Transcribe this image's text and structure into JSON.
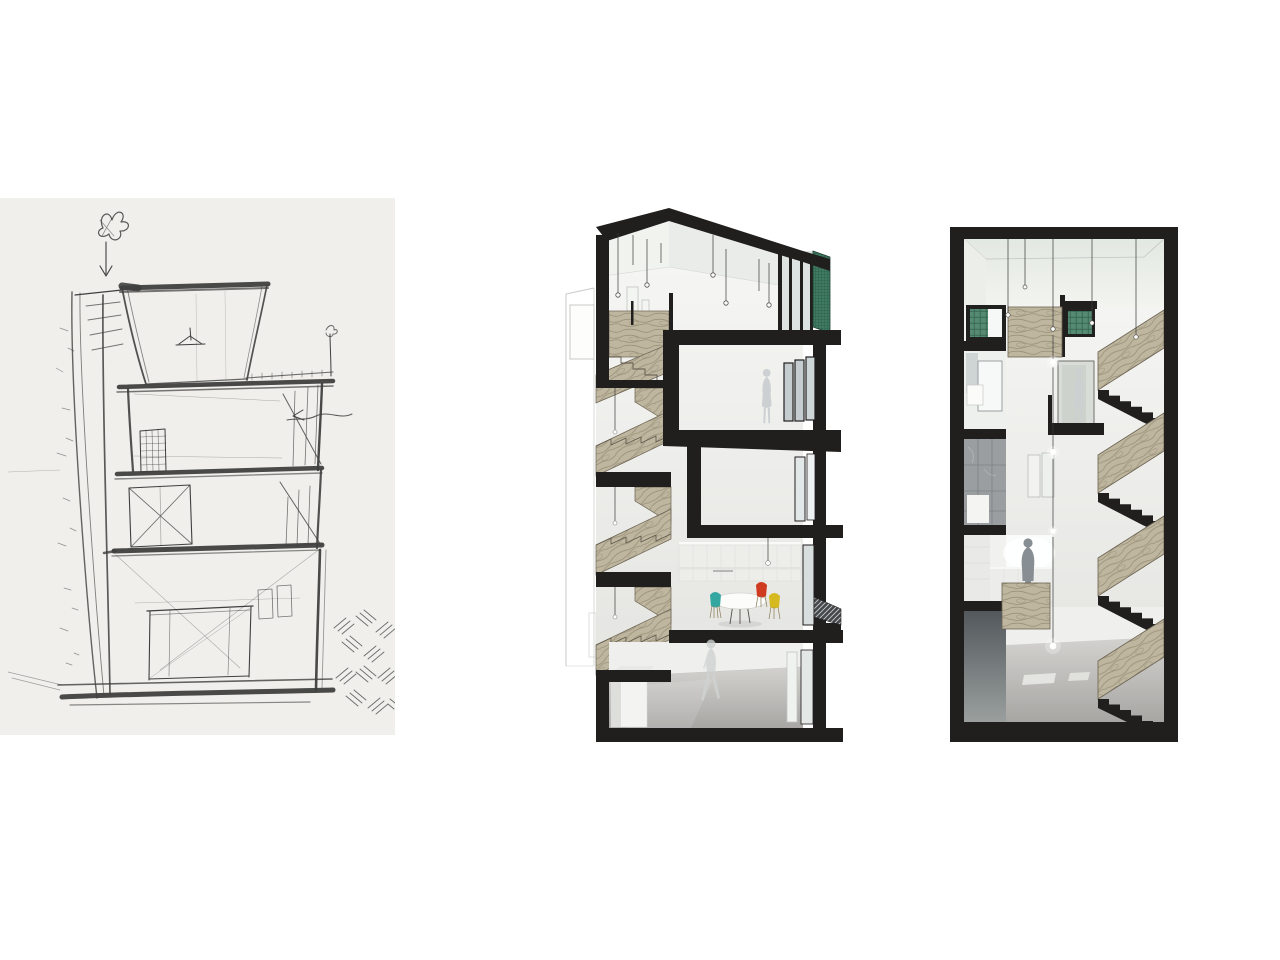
{
  "board": {
    "title": "architectural presentation board",
    "description": "Three-panel architectural study of a narrow multi-storey townhouse: concept sketch, sectional cutaway render, stair-core section render"
  },
  "panels": {
    "sketch": {
      "label": "concept-sketch",
      "medium": "pencil on paper",
      "description": "Hand-drawn pencil section sketch of a four-storey house with planting symbol and down arrow at top, sloped party wall with moss ticks at left, stair diagonals at right, double-height ground room with table, and basket-weave ground hatching at bottom right",
      "floors_visible": 4
    },
    "cutaway": {
      "label": "sectional-cutaway-render",
      "description": "Rendered sectional perspective: top-lit attic with pendant bulbs and timber switchback stair, bedroom with standing woman, white study room, kitchen-dining room with round white table and teal, red and yellow chairs, double-height ground hall with walking man, green perforated mesh screen at top right, concrete floors, black cut poche",
      "floors_visible": 5,
      "figures": [
        "standing woman",
        "walking man"
      ],
      "furniture": [
        "round dining table",
        "teal chair",
        "red chair",
        "yellow chair"
      ]
    },
    "stairwell": {
      "label": "stair-core-section-render",
      "description": "Rendered section through the stair core framed in black poche: timber scissor stair flights with black stepped soffits, green glass-block windows, bathroom, marble shower room, kitchen with backlit standing man, woman by a door, glowing pendant bulbs dropping through the void, concrete ground slab",
      "floors_visible": 5,
      "stair_flights_visible": 4,
      "figures": [
        "standing woman",
        "standing man"
      ]
    }
  },
  "palette": {
    "page_bg": "#ffffff",
    "sketch_paper": "#f0efec",
    "pencil": "#3f3f3f",
    "poche": "#211f1e",
    "wall_light": "#f6f6f4",
    "wall_shade": "#e3e3e0",
    "ceiling_green": "#e4eae2",
    "wood_base": "#bfb6a0",
    "wood_grain": "#857c63",
    "glass_block_green": "#4c7e67",
    "mesh_green": "#3f7a62",
    "concrete_light": "#d2d1ce",
    "concrete_dark": "#a8a7a4",
    "figure_light": "#cbcfd1",
    "figure_dark": "#7f868b",
    "chair_teal": "#35a7a1",
    "chair_red": "#cf3a20",
    "chair_yellow": "#d6b91e",
    "neighbor_line": "#c9c9c6",
    "marble_gray": "#9a9ea1",
    "dark_room": "#565c60"
  }
}
